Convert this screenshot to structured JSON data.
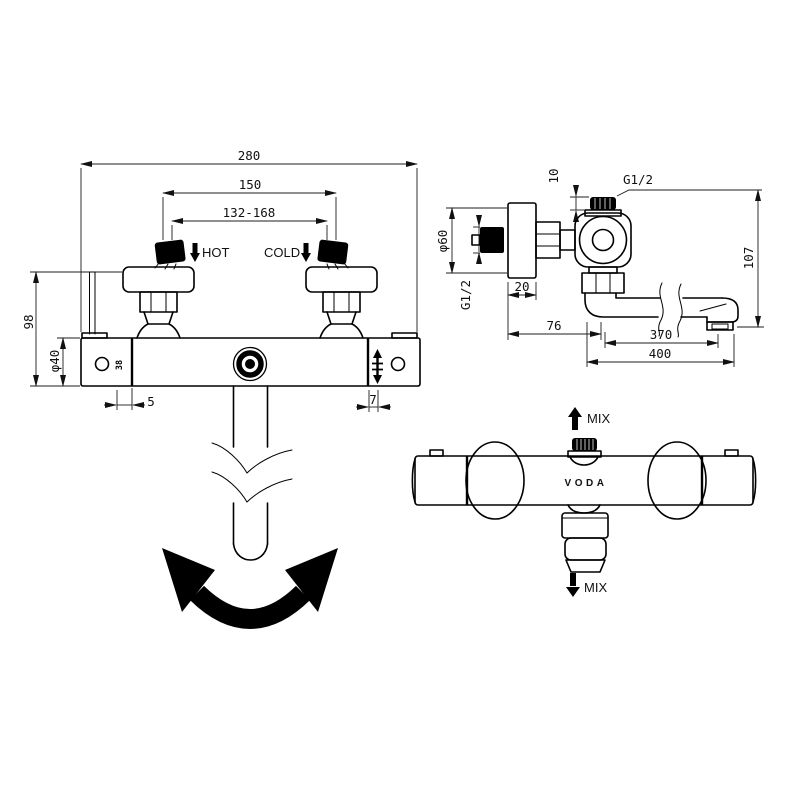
{
  "drawing": {
    "title": "thermostatic-bath-shower-mixer-dimension-drawing",
    "bg_color": "#ffffff",
    "line_color": "#000000",
    "front_view": {
      "dim_width": "280",
      "dim_inlet_spacing": "150",
      "dim_adjust_range": "132-168",
      "label_hot": "HOT",
      "label_cold": "COLD",
      "dim_height": "98",
      "dim_cap_diameter": "φ40",
      "dim_offset_left": "5",
      "dim_offset_right": "7",
      "cap_marking": "38"
    },
    "side_view": {
      "dim_cap_offset": "10",
      "thread_top": "G1/2",
      "dim_plate_diameter": "φ60",
      "thread_wall": "G1/2",
      "dim_plate_depth": "20",
      "dim_wall_to_spout": "76",
      "dim_spout_reach": "370",
      "dim_total_reach": "400",
      "dim_height": "107"
    },
    "top_view": {
      "label_mix_up": "MIX",
      "label_mix_down": "MIX",
      "brand": "VODA"
    }
  }
}
